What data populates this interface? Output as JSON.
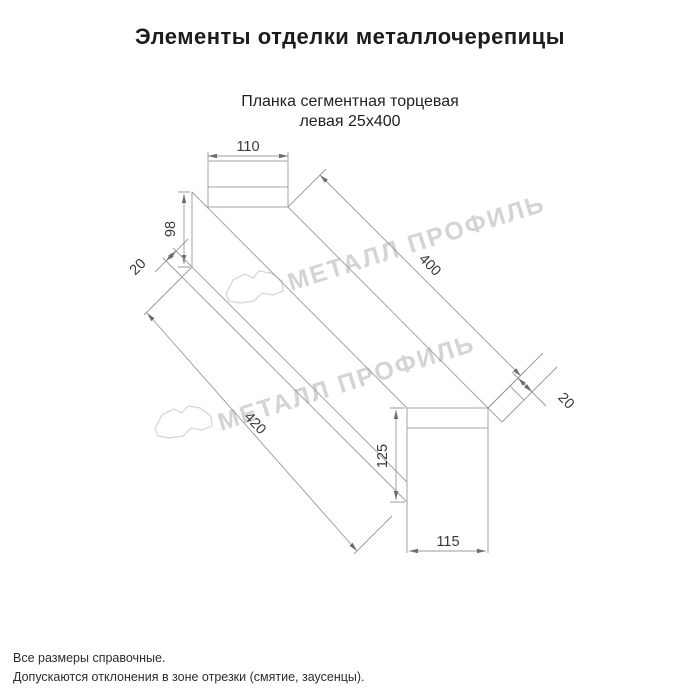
{
  "page": {
    "title": "Элементы отделки металлочерепицы",
    "subtitle_line1": "Планка сегментная торцевая",
    "subtitle_line2": "левая 25х400",
    "footer_line1": "Все размеры справочные.",
    "footer_line2": "Допускаются отклонения в зоне отрезки (смятие, заусенцы)."
  },
  "watermark": {
    "text": "МЕТАЛЛ ПРОФИЛЬ",
    "color": "#d4d4d4"
  },
  "drawing": {
    "type": "technical-line-drawing",
    "line_color": "#a3a3a3",
    "dim_text_color": "#3a3a3a",
    "dimensions": {
      "top_width": "110",
      "left_height": "98",
      "left_fold": "20",
      "length_top": "400",
      "length_bottom": "420",
      "right_height": "125",
      "bottom_width": "115",
      "right_fold": "20"
    }
  }
}
